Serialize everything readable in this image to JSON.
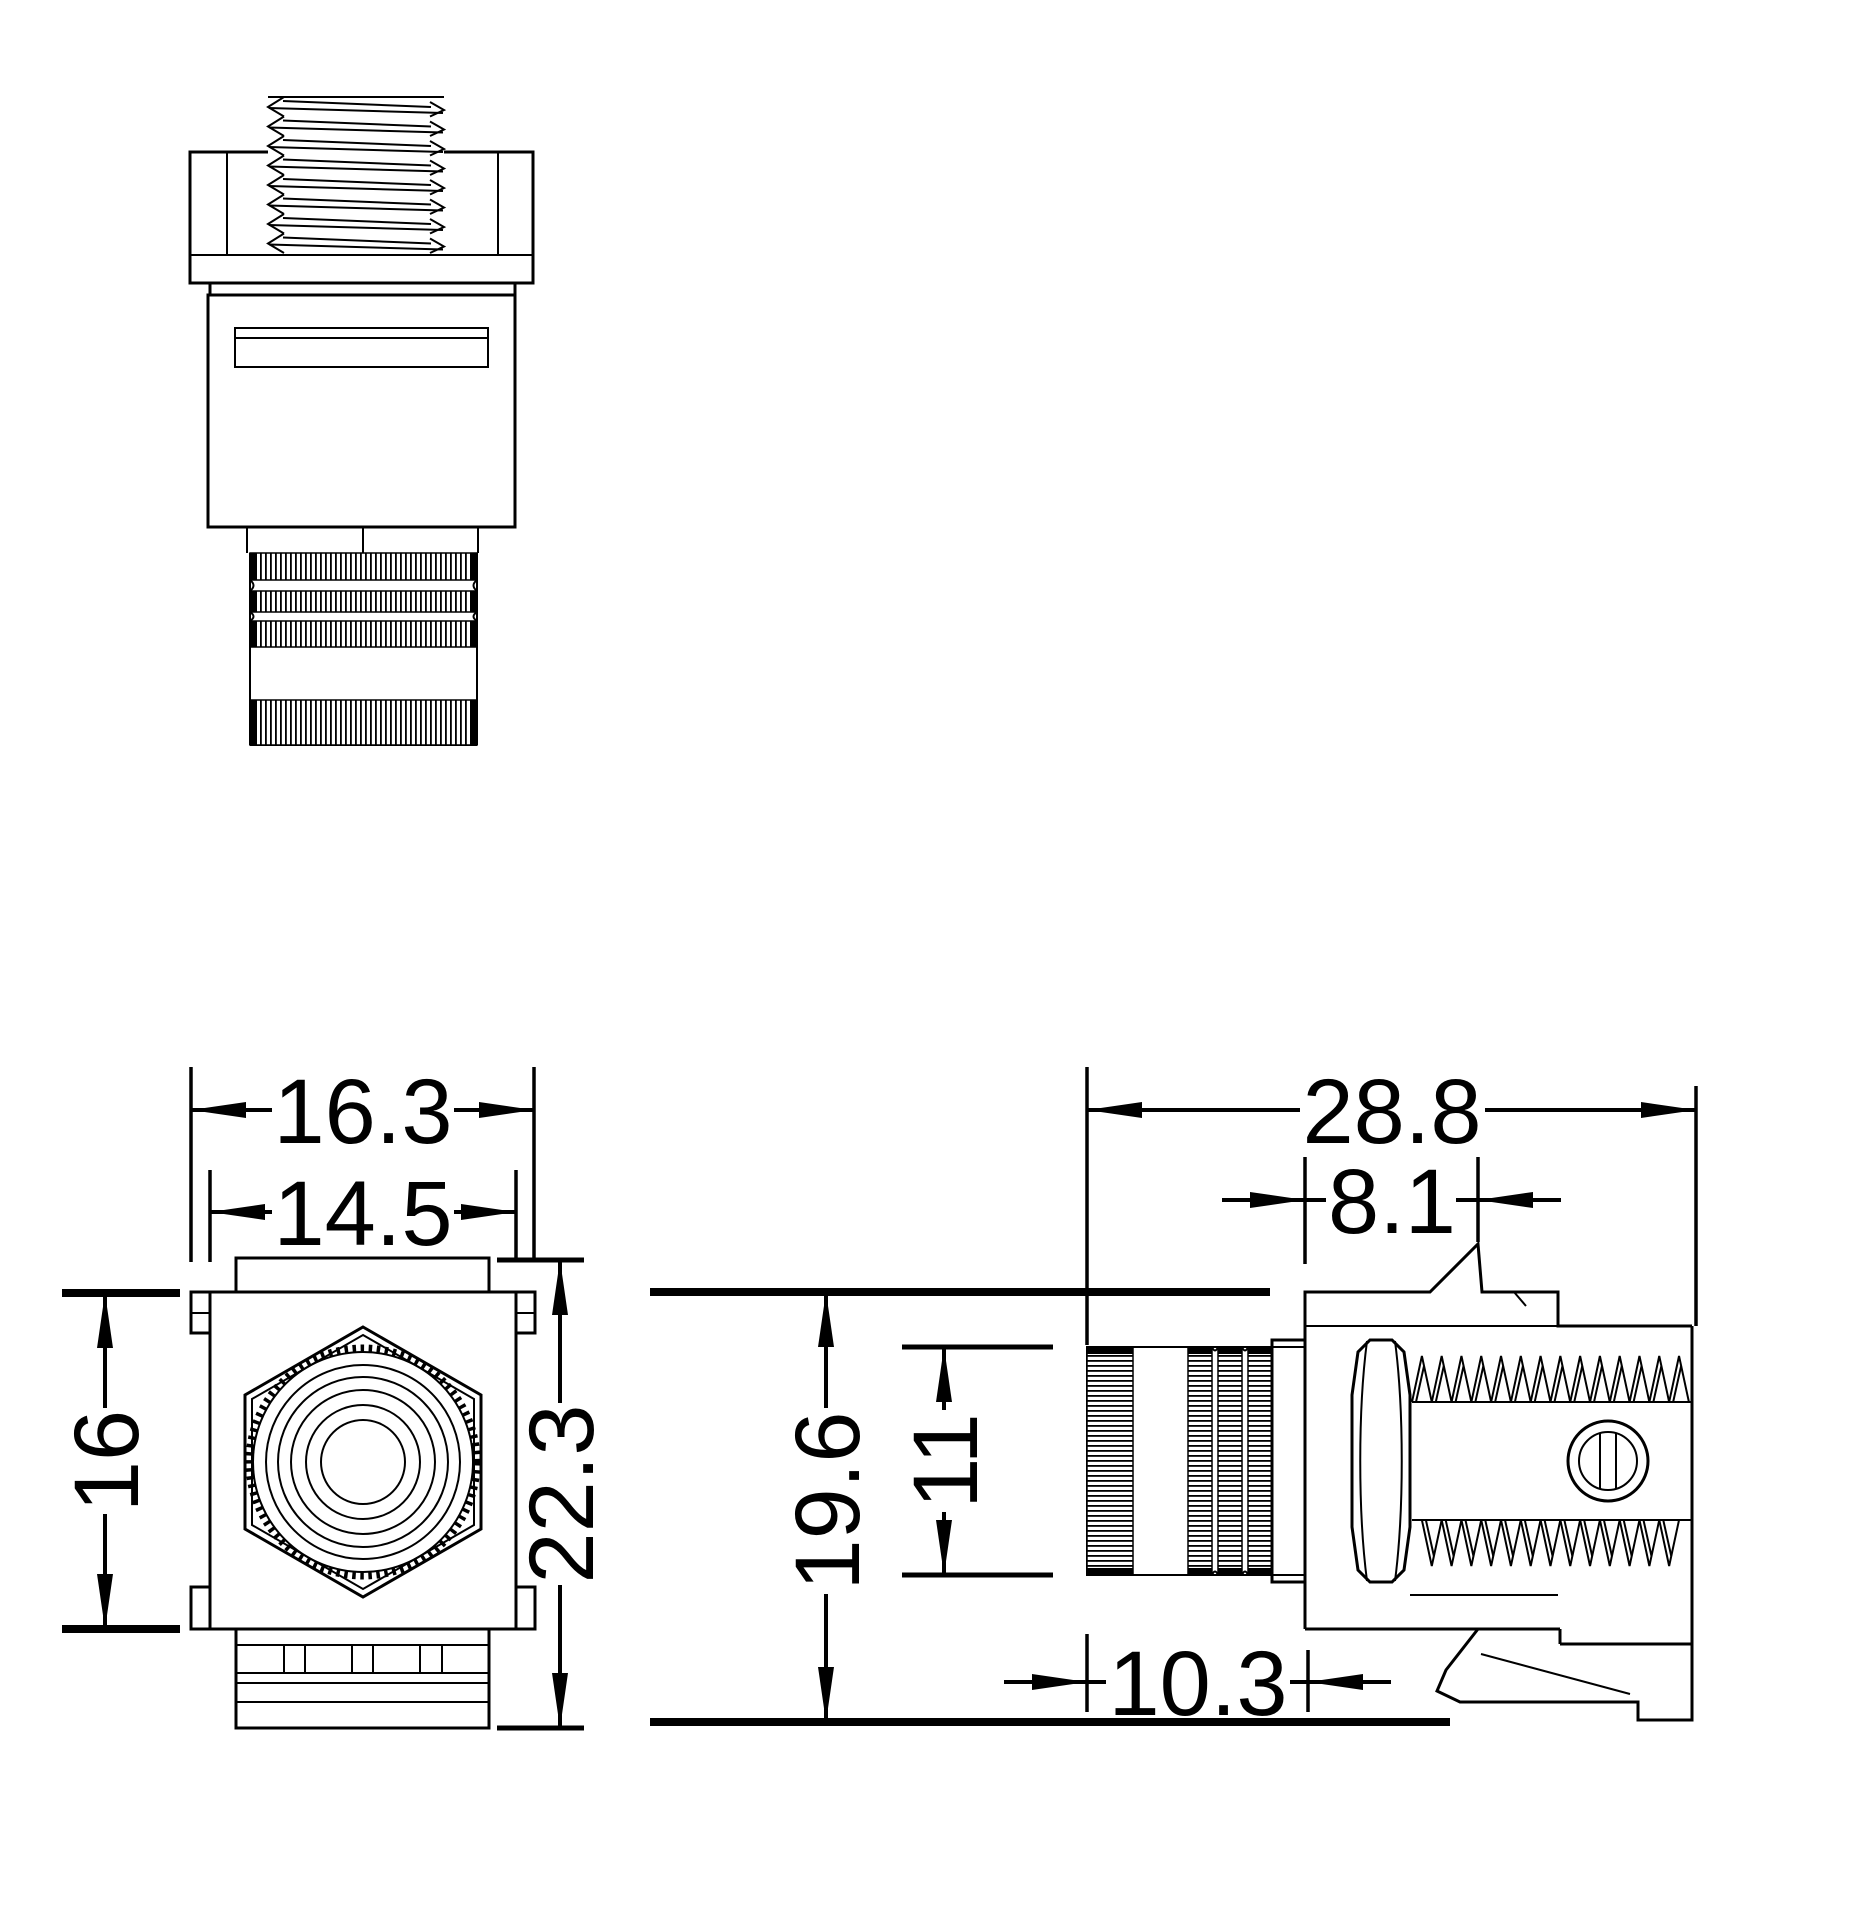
{
  "colors": {
    "ink": "#000000",
    "paper": "#ffffff"
  },
  "dims": {
    "front_width_outer": "16.3",
    "front_width_inner": "14.5",
    "front_height": "16",
    "front_height_total": "22.3",
    "side_length_total": "28.8",
    "side_latch_depth": "8.1",
    "side_height_total": "19.6",
    "side_barrel_dia": "11",
    "side_barrel_len": "10.3"
  }
}
